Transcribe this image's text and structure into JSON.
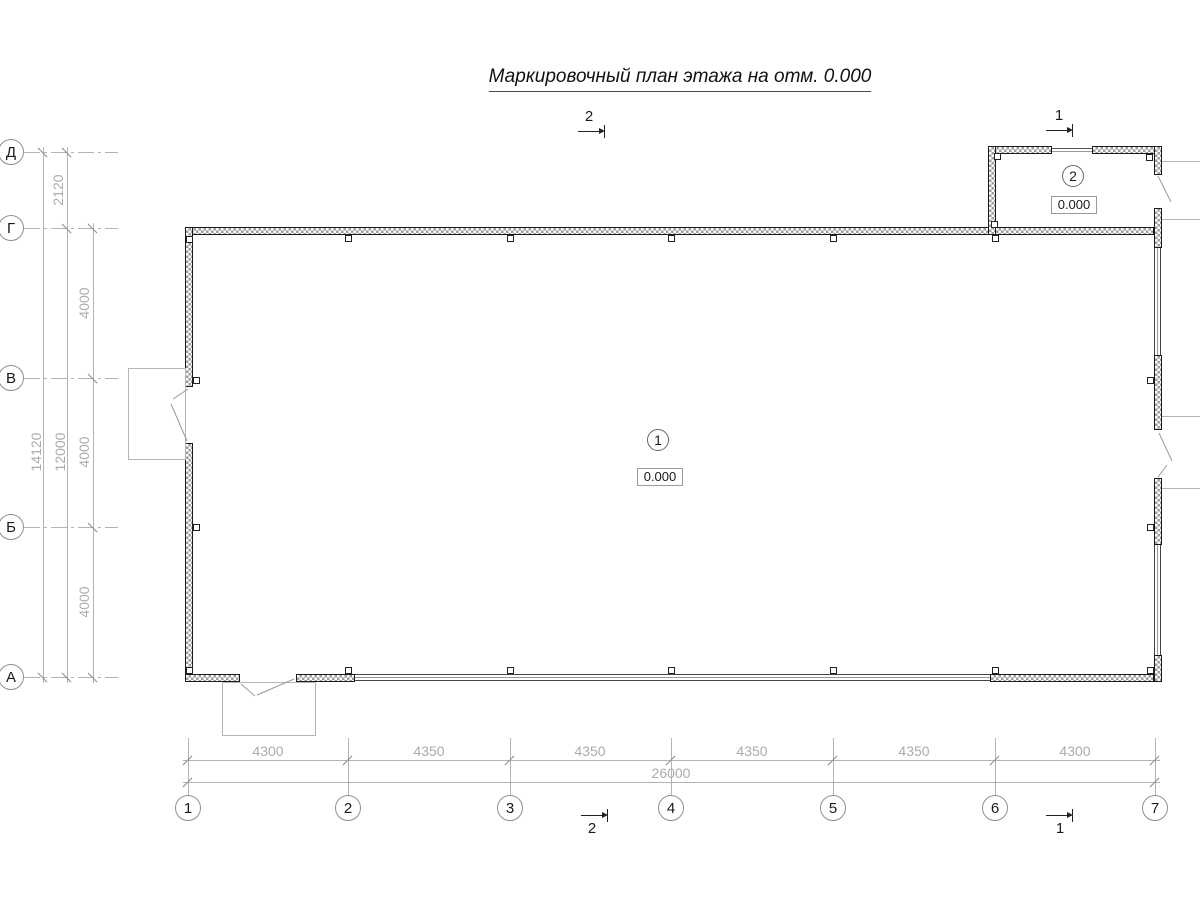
{
  "title": "Маркировочный план этажа на отм. 0.000",
  "colors": {
    "wall_outline": "#1a1a1a",
    "wall_hatch": "#9e9e9e",
    "dim_line": "#b3b3b3",
    "dim_text": "#ababab",
    "annotation_text": "#1a1a1a"
  },
  "axes": {
    "rows": [
      {
        "label": "Д"
      },
      {
        "label": "Г"
      },
      {
        "label": "В"
      },
      {
        "label": "Б"
      },
      {
        "label": "А"
      }
    ],
    "cols": [
      {
        "label": "1"
      },
      {
        "label": "2"
      },
      {
        "label": "3"
      },
      {
        "label": "4"
      },
      {
        "label": "5"
      },
      {
        "label": "6"
      },
      {
        "label": "7"
      }
    ]
  },
  "dims_left": {
    "total": "14120",
    "subtotal": "12000",
    "bay_d_g": "2120",
    "bay_g_v": "4000",
    "bay_v_b": "4000",
    "bay_b_a": "4000"
  },
  "dims_bottom": {
    "total": "26000",
    "bays": [
      "4300",
      "4350",
      "4350",
      "4350",
      "4350",
      "4300"
    ]
  },
  "rooms": [
    {
      "number": "1",
      "elevation": "0.000"
    },
    {
      "number": "2",
      "elevation": "0.000"
    }
  ],
  "sections": {
    "s1": "1",
    "s2": "2"
  }
}
